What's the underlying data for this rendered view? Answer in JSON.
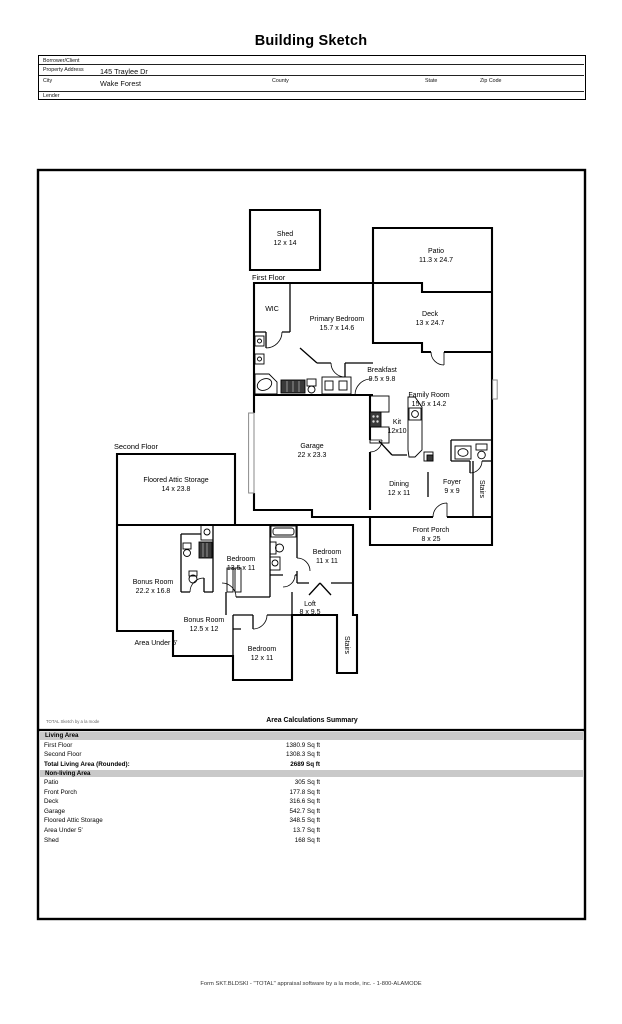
{
  "header": {
    "title": "Building Sketch",
    "borrower_label": "Borrower/Client",
    "property_label": "Property Address",
    "property_value": "145 Traylee Dr",
    "city_label": "City",
    "city_value": "Wake Forest",
    "county_label": "County",
    "state_label": "State",
    "zip_label": "Zip Code",
    "lender_label": "Lender"
  },
  "plan": {
    "first_floor_label": "First Floor",
    "second_floor_label": "Second Floor",
    "stairs_label": "Stairs",
    "rooms": {
      "shed": {
        "name": "Shed",
        "dims": "12 x 14"
      },
      "patio": {
        "name": "Patio",
        "dims": "11.3 x 24.7"
      },
      "deck": {
        "name": "Deck",
        "dims": "13 x 24.7"
      },
      "wic": {
        "name": "WIC"
      },
      "primary_bedroom": {
        "name": "Primary Bedroom",
        "dims": "15.7 x 14.6"
      },
      "breakfast": {
        "name": "Breakfast",
        "dims": "9.5 x 9.8"
      },
      "family_room": {
        "name": "Family Room",
        "dims": "15.6 x 14.2"
      },
      "kitchen": {
        "name": "Kit",
        "dims": "12x10"
      },
      "garage": {
        "name": "Garage",
        "dims": "22 x 23.3"
      },
      "dining": {
        "name": "Dining",
        "dims": "12 x 11"
      },
      "foyer": {
        "name": "Foyer",
        "dims": "9 x 9"
      },
      "front_porch": {
        "name": "Front Porch",
        "dims": "8 x 25"
      },
      "floored_attic": {
        "name": "Floored Attic Storage",
        "dims": "14 x 23.8"
      },
      "bedroom_a": {
        "name": "Bedroom",
        "dims": "13.5 x 11"
      },
      "bedroom_b": {
        "name": "Bedroom",
        "dims": "11 x 11"
      },
      "bonus_a": {
        "name": "Bonus Room",
        "dims": "22.2 x 16.8"
      },
      "bonus_b": {
        "name": "Bonus Room",
        "dims": "12.5 x 12"
      },
      "loft": {
        "name": "Loft",
        "dims": "8 x 9.5"
      },
      "bedroom_c": {
        "name": "Bedroom",
        "dims": "12 x 11"
      },
      "area_under": {
        "name": "Area Under 5'"
      }
    }
  },
  "summary": {
    "watermark": "TOTAL Sketch by a la mode",
    "title": "Area Calculations Summary",
    "living_header": "Living Area",
    "nonliving_header": "Non-living Area",
    "living_rows": [
      {
        "label": "First Floor",
        "value": "1380.9 Sq ft"
      },
      {
        "label": "Second Floor",
        "value": "1308.3 Sq ft"
      }
    ],
    "total_label": "Total Living Area (Rounded):",
    "total_value": "2689 Sq ft",
    "nonliving_rows": [
      {
        "label": "Patio",
        "value": "305 Sq ft"
      },
      {
        "label": "Front Porch",
        "value": "177.8 Sq ft"
      },
      {
        "label": "Deck",
        "value": "316.6 Sq ft"
      },
      {
        "label": "Garage",
        "value": "542.7 Sq ft"
      },
      {
        "label": "Floored Attic Storage",
        "value": "348.5 Sq ft"
      },
      {
        "label": "Area Under 5'",
        "value": "13.7 Sq ft"
      },
      {
        "label": "Shed",
        "value": "168 Sq ft"
      }
    ]
  },
  "footer": {
    "text": "Form SKT.BLDSKI - \"TOTAL\" appraisal software by a la mode, inc. - 1-800-ALAMODE"
  }
}
